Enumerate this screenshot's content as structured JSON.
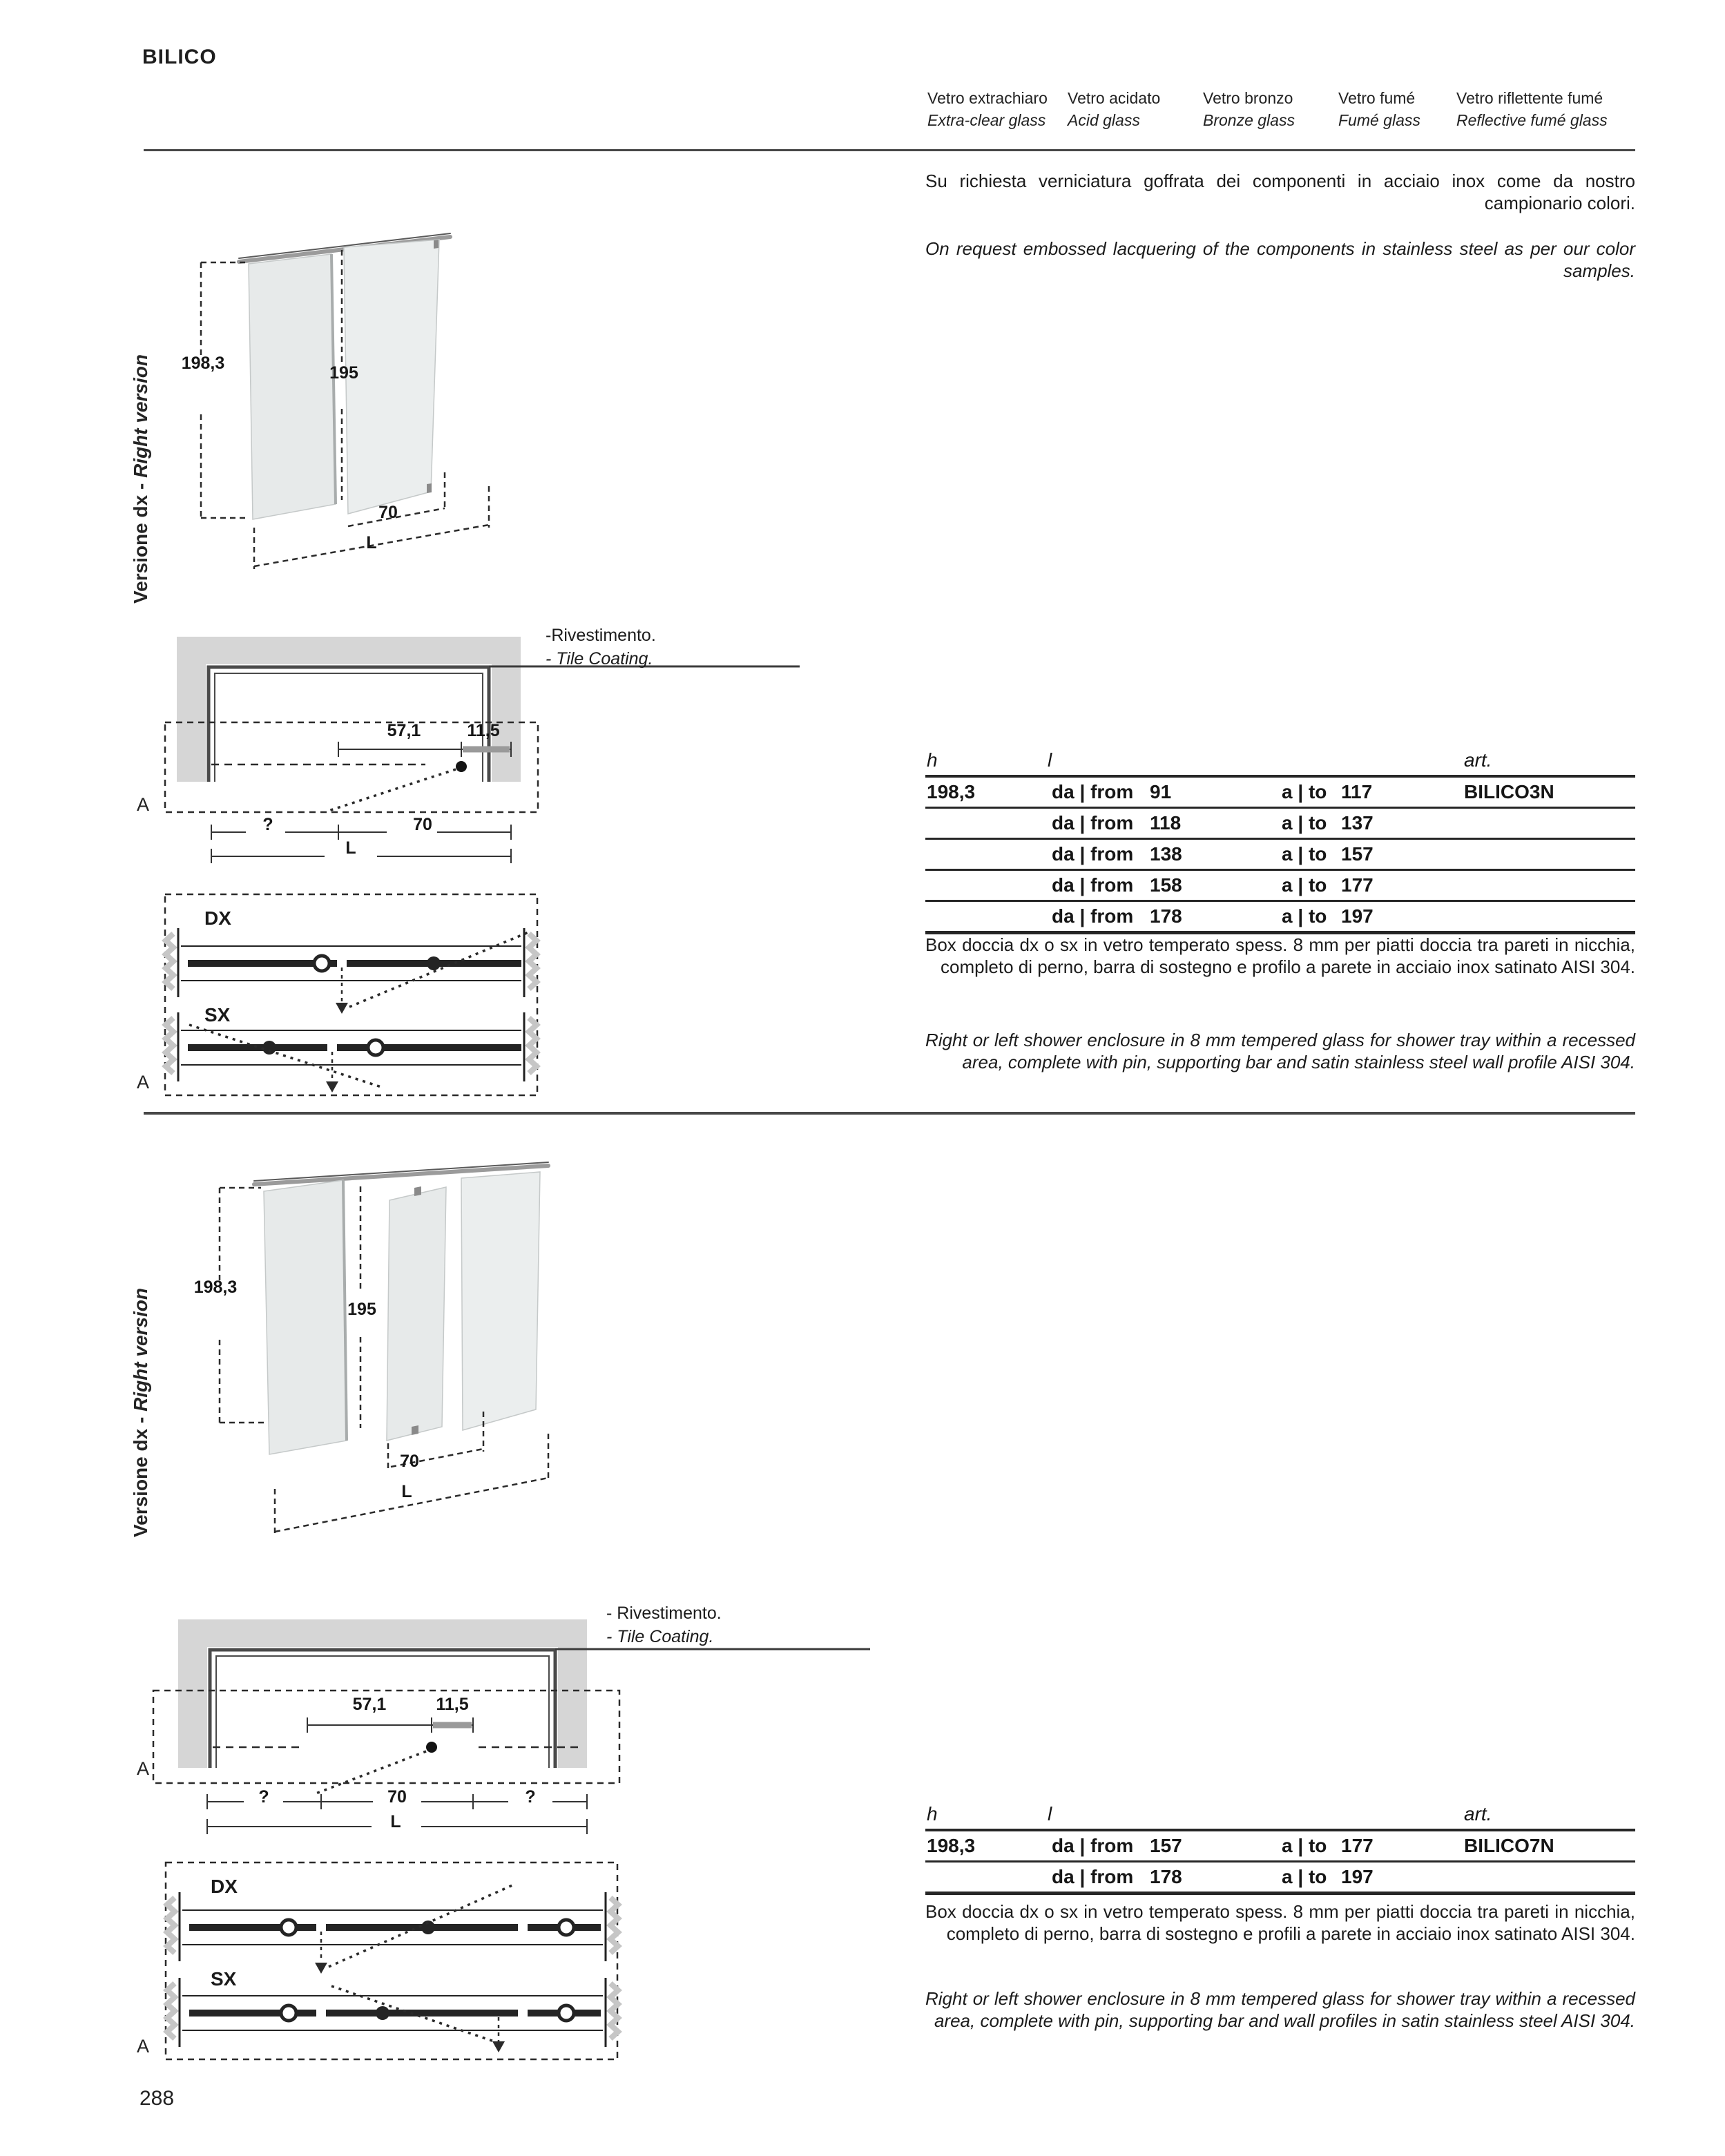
{
  "page": {
    "title": "BILICO",
    "number": "288"
  },
  "glass_types": [
    {
      "it": "Vetro extrachiaro",
      "en": "Extra-clear glass"
    },
    {
      "it": "Vetro acidato",
      "en": "Acid glass"
    },
    {
      "it": "Vetro bronzo",
      "en": "Bronze glass"
    },
    {
      "it": "Vetro fumé",
      "en": "Fumé glass"
    },
    {
      "it": "Vetro riflettente fumé",
      "en": "Reflective fumé glass"
    }
  ],
  "intro": {
    "it": "Su richiesta verniciatura goffrata dei componenti in acciaio inox come da nostro campionario colori.",
    "en": "On request embossed lacquering of the components in stainless steel as per our color samples."
  },
  "sections": [
    {
      "version_it": "Versione dx - ",
      "version_en": "Right version",
      "iso": {
        "total": "198,3",
        "inner": "195",
        "width": "70",
        "length": "L"
      },
      "plan": {
        "offset": "57,1",
        "pin": "11,5",
        "var1": "?",
        "width": "70",
        "length": "L"
      },
      "coating_it": "-Rivestimento.",
      "coating_en": "- Tile Coating.",
      "zone": "A",
      "dx": "DX",
      "sx": "SX",
      "table": {
        "h": "h",
        "l": "l",
        "art": "art.",
        "rows": [
          {
            "h": "198,3",
            "da": "da | from",
            "from": "91",
            "a": "a | to",
            "to": "117",
            "art": "BILICO3N"
          },
          {
            "h": "",
            "da": "da | from",
            "from": "118",
            "a": "a | to",
            "to": "137",
            "art": ""
          },
          {
            "h": "",
            "da": "da | from",
            "from": "138",
            "a": "a | to",
            "to": "157",
            "art": ""
          },
          {
            "h": "",
            "da": "da | from",
            "from": "158",
            "a": "a | to",
            "to": "177",
            "art": ""
          },
          {
            "h": "",
            "da": "da | from",
            "from": "178",
            "a": "a | to",
            "to": "197",
            "art": ""
          }
        ]
      },
      "desc_it": "Box doccia dx o sx in vetro temperato spess. 8 mm per piatti doccia tra pareti in nicchia, completo di perno, barra di sostegno e profilo a parete in acciaio inox satinato AISI 304.",
      "desc_en": "Right or left shower enclosure in 8 mm tempered glass for shower tray within a recessed area, complete with pin, supporting bar and satin stainless steel wall profile AISI 304."
    },
    {
      "version_it": "Versione dx - ",
      "version_en": "Right version",
      "iso": {
        "total": "198,3",
        "inner": "195",
        "width": "70",
        "length": "L"
      },
      "plan": {
        "offset": "57,1",
        "pin": "11,5",
        "var1": "?",
        "width": "70",
        "var2": "?",
        "length": "L"
      },
      "coating_it": "- Rivestimento.",
      "coating_en": "- Tile Coating.",
      "zone": "A",
      "dx": "DX",
      "sx": "SX",
      "table": {
        "h": "h",
        "l": "l",
        "art": "art.",
        "rows": [
          {
            "h": "198,3",
            "da": "da | from",
            "from": "157",
            "a": "a | to",
            "to": "177",
            "art": "BILICO7N"
          },
          {
            "h": "",
            "da": "da | from",
            "from": "178",
            "a": "a | to",
            "to": "197",
            "art": ""
          }
        ]
      },
      "desc_it": "Box doccia dx o sx in vetro temperato spess. 8 mm per piatti doccia tra pareti in nicchia, completo di perno, barra di sostegno e profili a parete in acciaio inox satinato AISI 304.",
      "desc_en": "Right or left shower enclosure in 8 mm tempered glass for shower tray within a recessed area, complete with pin, supporting bar and wall profiles in satin stainless steel AISI 304."
    }
  ]
}
